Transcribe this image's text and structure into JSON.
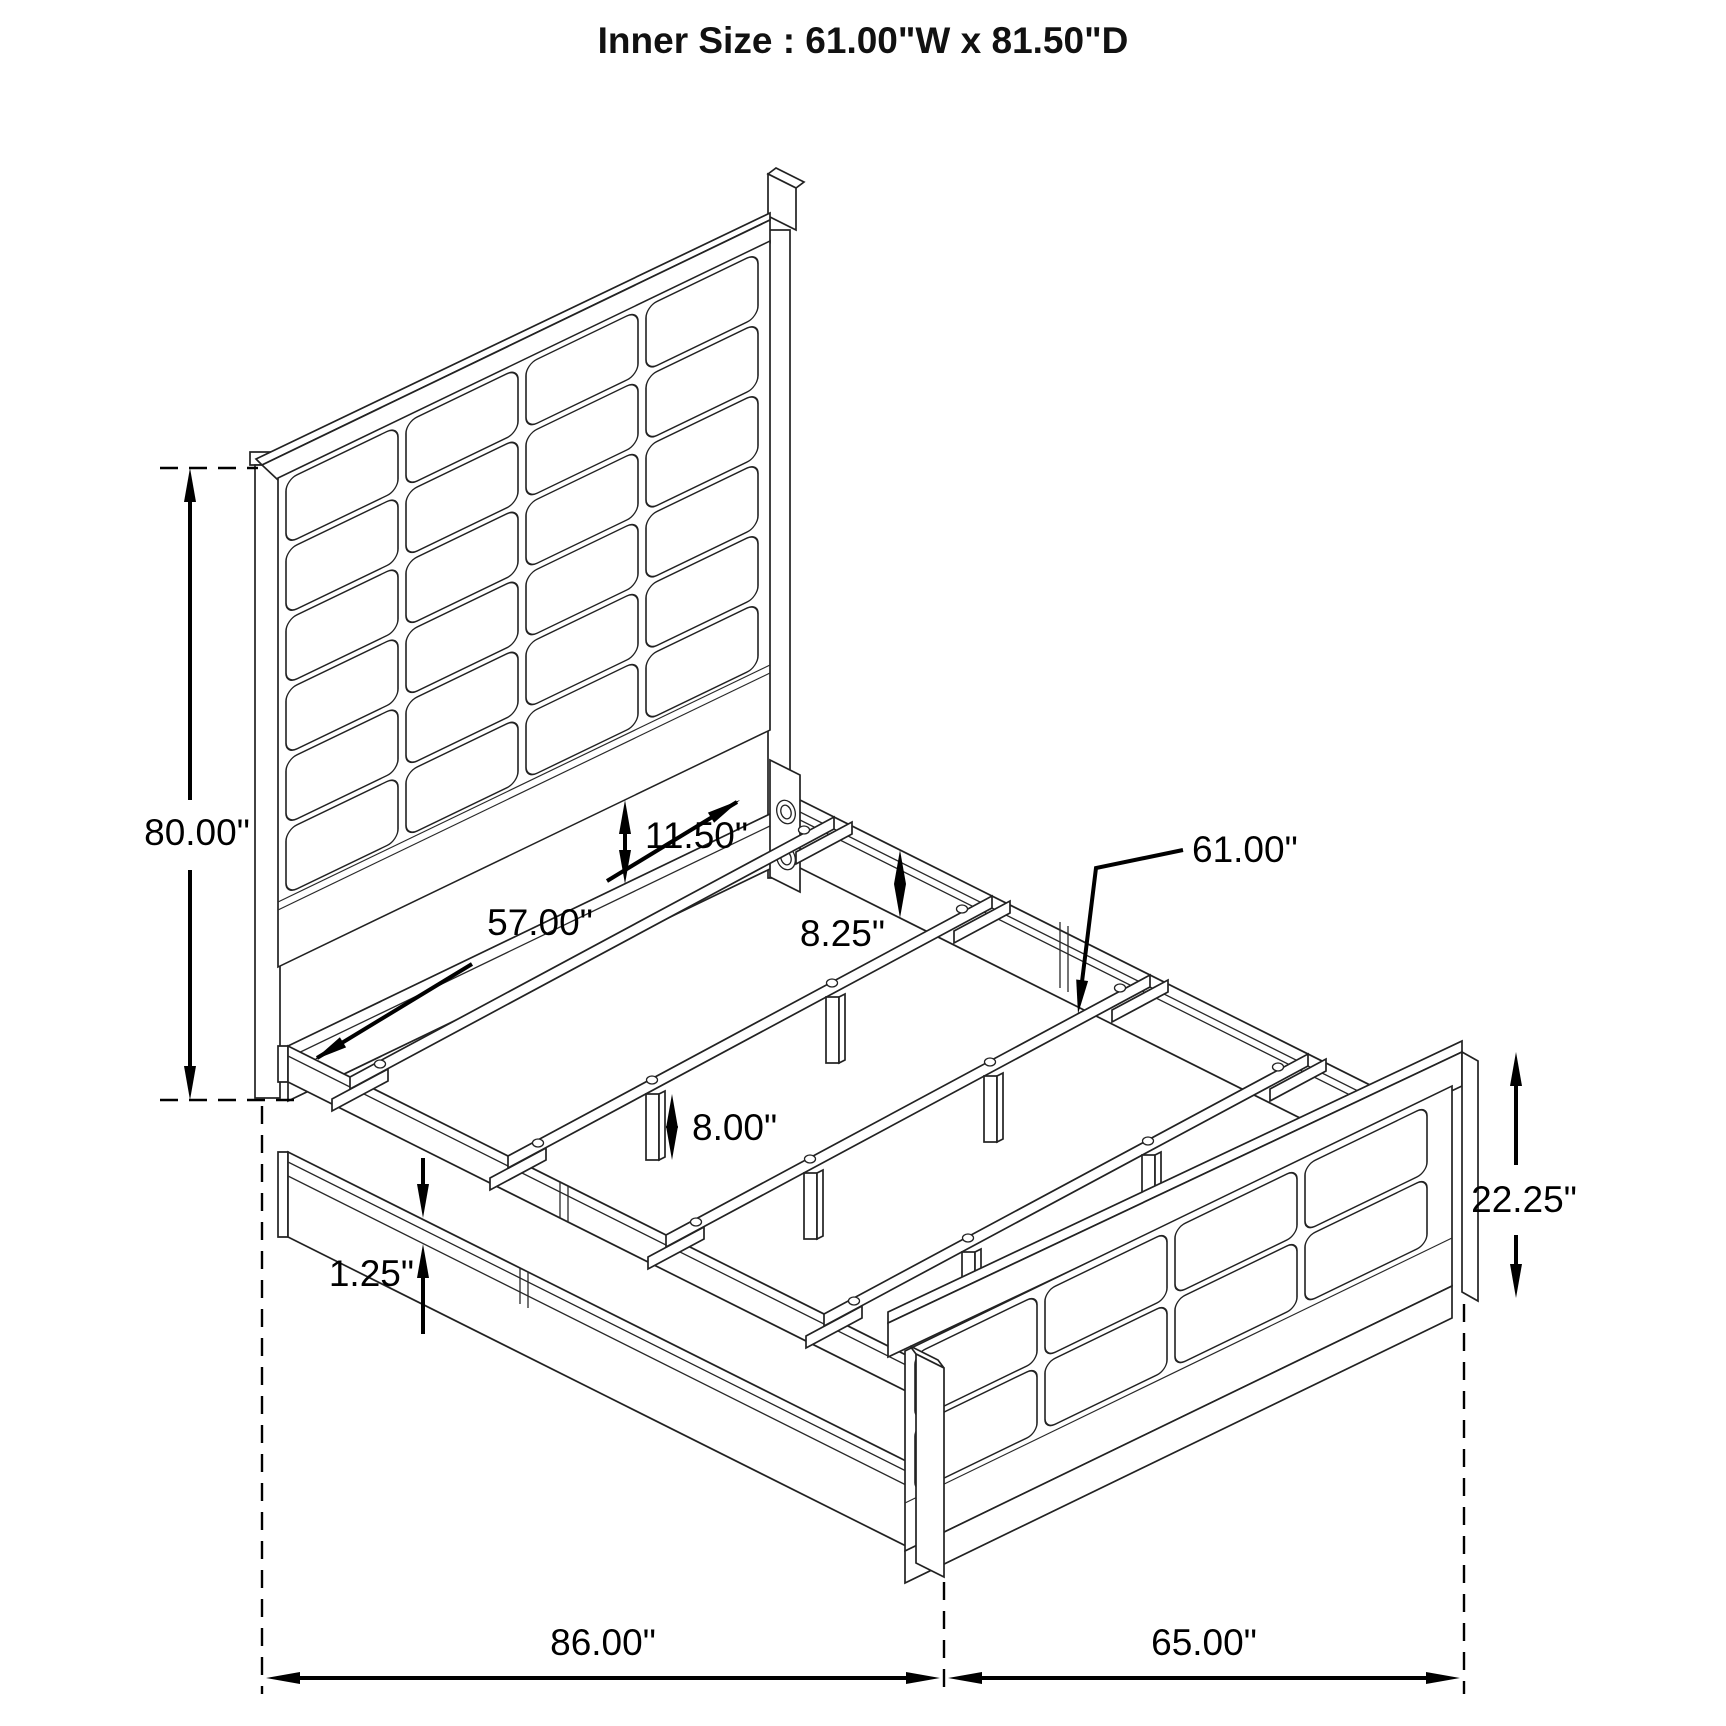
{
  "title": "Inner Size : 61.00\"W x 81.50\"D",
  "diagram_subject": "bed frame assembly isometric drawing",
  "dimensions": {
    "headboard_height": "80.00\"",
    "headboard_panel_gap": "11.50\"",
    "inner_width_head": "57.00\"",
    "side_rail_height": "8.25\"",
    "slat_length": "61.00\"",
    "leg_height": "8.00\"",
    "rail_lip_thickness": "1.25\"",
    "footboard_height": "22.25\"",
    "overall_length": "86.00\"",
    "overall_width_foot": "65.00\""
  }
}
